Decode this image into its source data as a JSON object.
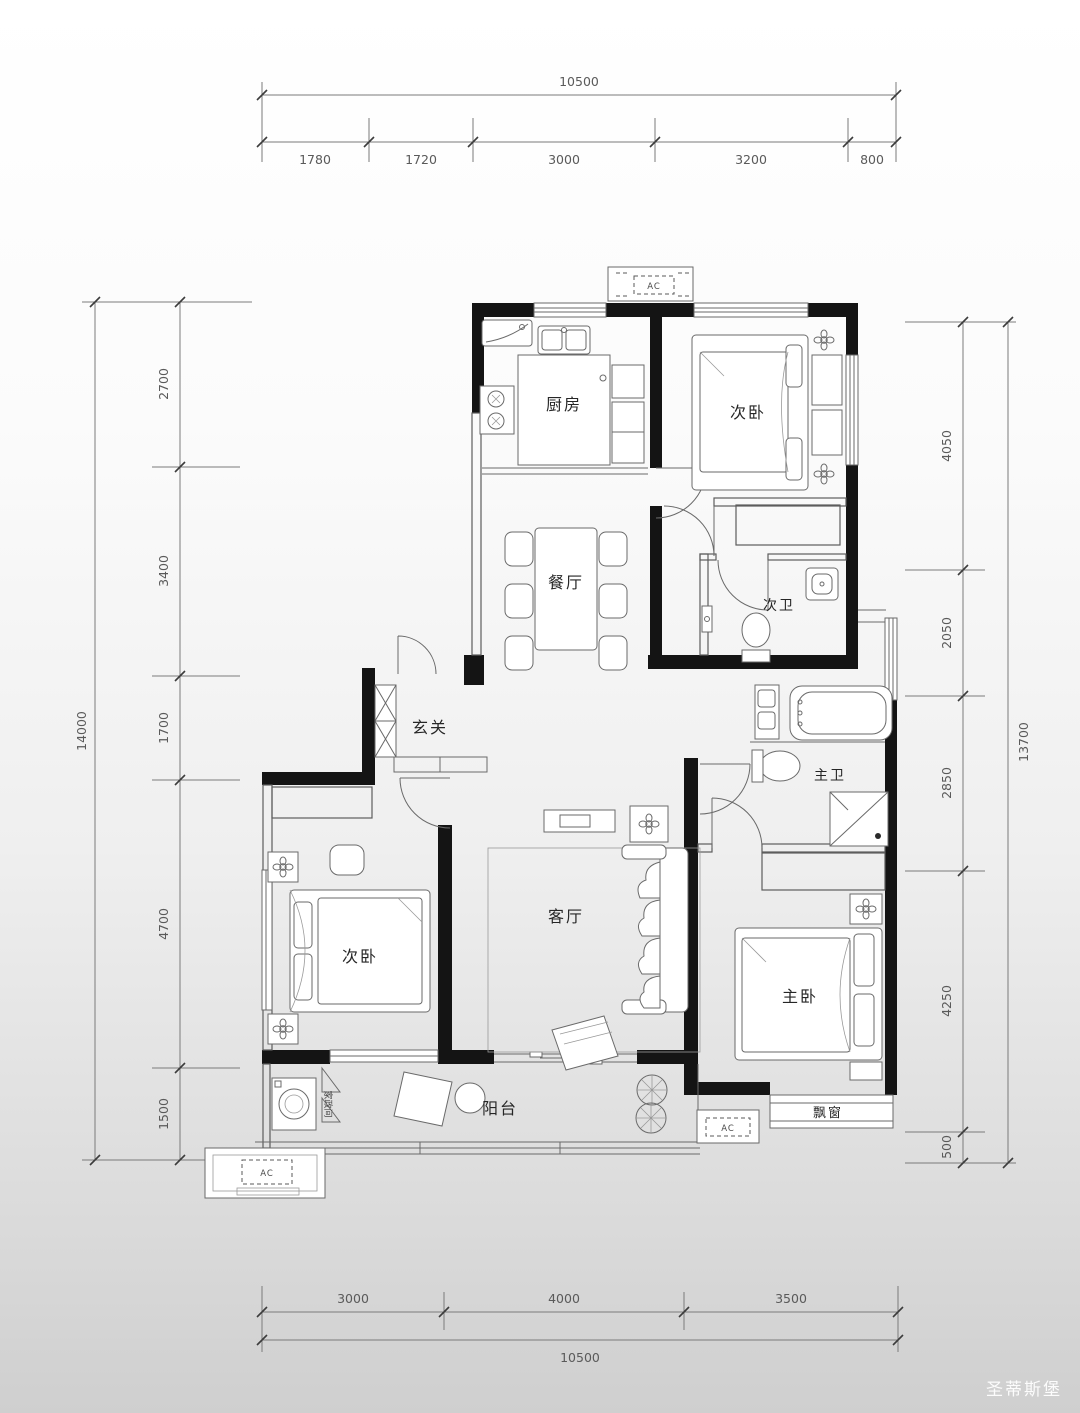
{
  "rooms": {
    "kitchen": "厨房",
    "bedroom_top": "次卧",
    "dining": "餐厅",
    "bath2": "次卫",
    "foyer": "玄关",
    "bedroom_left": "次卧",
    "living": "客厅",
    "bath1": "主卫",
    "master": "主卧",
    "balcony": "阳台",
    "bay_window": "飘窗",
    "laundry": "家政间"
  },
  "labels": {
    "ac": "AC",
    "watermark": "圣蒂斯堡"
  },
  "dims": {
    "top": {
      "total": "10500",
      "segs": [
        "1780",
        "1720",
        "3000",
        "3200",
        "800"
      ]
    },
    "bottom": {
      "total": "10500",
      "segs": [
        "3000",
        "4000",
        "3500"
      ]
    },
    "left": {
      "total": "14000",
      "segs": [
        "2700",
        "3400",
        "1700",
        "4700",
        "1500"
      ]
    },
    "right": {
      "total": "13700",
      "segs": [
        "4050",
        "2050",
        "2850",
        "4250",
        "500"
      ]
    }
  }
}
